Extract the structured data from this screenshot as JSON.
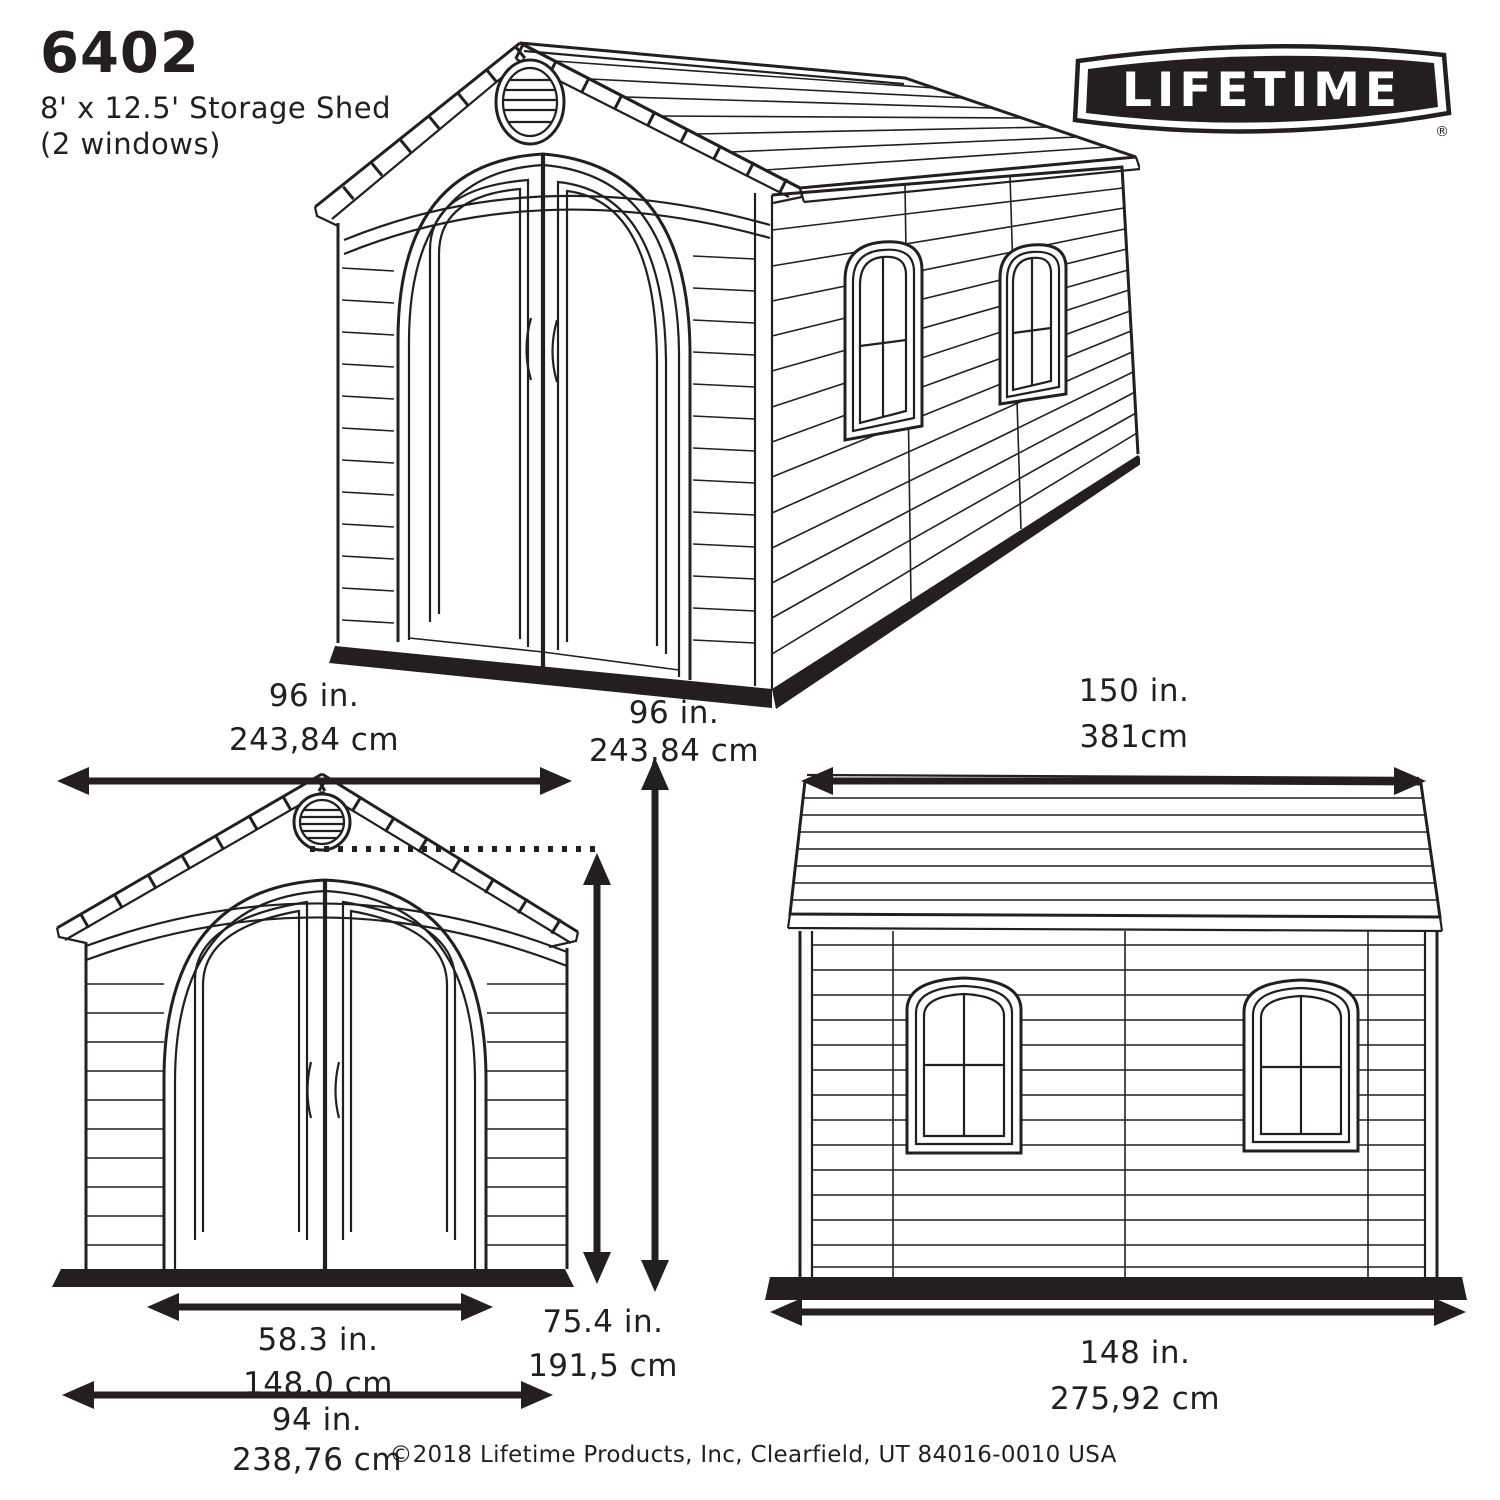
{
  "title_block": {
    "model": "6402",
    "description": "8' x 12.5' Storage Shed",
    "windows_note": "(2 windows)"
  },
  "logo": {
    "brand": "LIFETIME",
    "registered_mark": "®"
  },
  "dimensions": {
    "front_width": {
      "inches": "96 in.",
      "cm": "243,84 cm"
    },
    "overall_height": {
      "inches": "96 in.",
      "cm": "243,84 cm"
    },
    "side_depth": {
      "inches": "150 in.",
      "cm": "381cm"
    },
    "door_width": {
      "inches": "58.3 in.",
      "cm": "148,0 cm"
    },
    "door_height": {
      "inches": "75.4 in.",
      "cm": "191,5 cm"
    },
    "base_front_width": {
      "inches": "94 in.",
      "cm": "238,76 cm"
    },
    "base_side_length": {
      "inches": "148 in.",
      "cm": "275,92 cm"
    }
  },
  "footer": {
    "copyright": "©2018 Lifetime Products, Inc, Clearfield, UT 84016-0010 USA"
  },
  "colors": {
    "ink": "#231f20",
    "paper": "#ffffff"
  }
}
